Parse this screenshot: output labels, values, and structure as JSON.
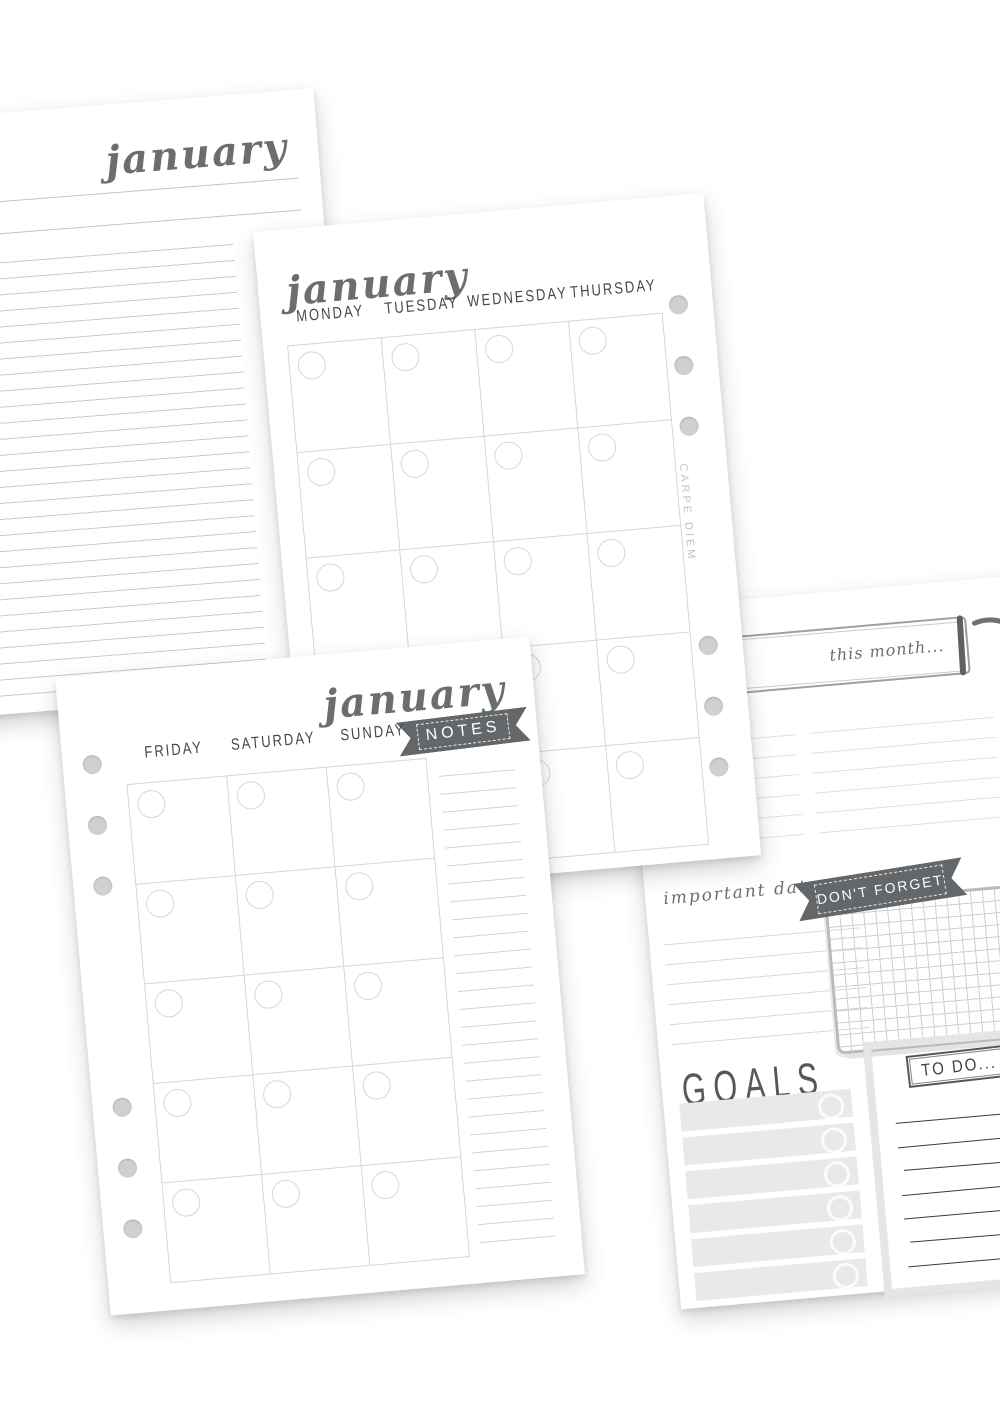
{
  "pages": {
    "notes": {
      "title": "january"
    },
    "calendar_mon_thu": {
      "title": "january",
      "days": [
        "MONDAY",
        "TUESDAY",
        "WEDNESDAY",
        "THURSDAY"
      ],
      "brand": "CARPE DIEM"
    },
    "calendar_fri_sun": {
      "title": "january",
      "days": [
        "FRIDAY",
        "SATURDAY",
        "SUNDAY"
      ],
      "ribbon": "NOTES"
    },
    "month_overview": {
      "banner": "this month...",
      "important_dates_label": "important dates",
      "dont_forget_ribbon": "DON'T FORGET",
      "goals_label": "GOALS",
      "todo_label": "TO DO..."
    }
  },
  "colors": {
    "script_ink": "#6b6e70",
    "header_ink": "#46494b",
    "ribbon_bg": "#63676a",
    "ribbon_text": "#ffffff",
    "rule_line": "#c9cbcc",
    "grid_line": "#d4d6d7",
    "todo_line": "#393b3c",
    "goal_bar": "#e8e9e9",
    "punch_hole": "#cfd1d1"
  }
}
